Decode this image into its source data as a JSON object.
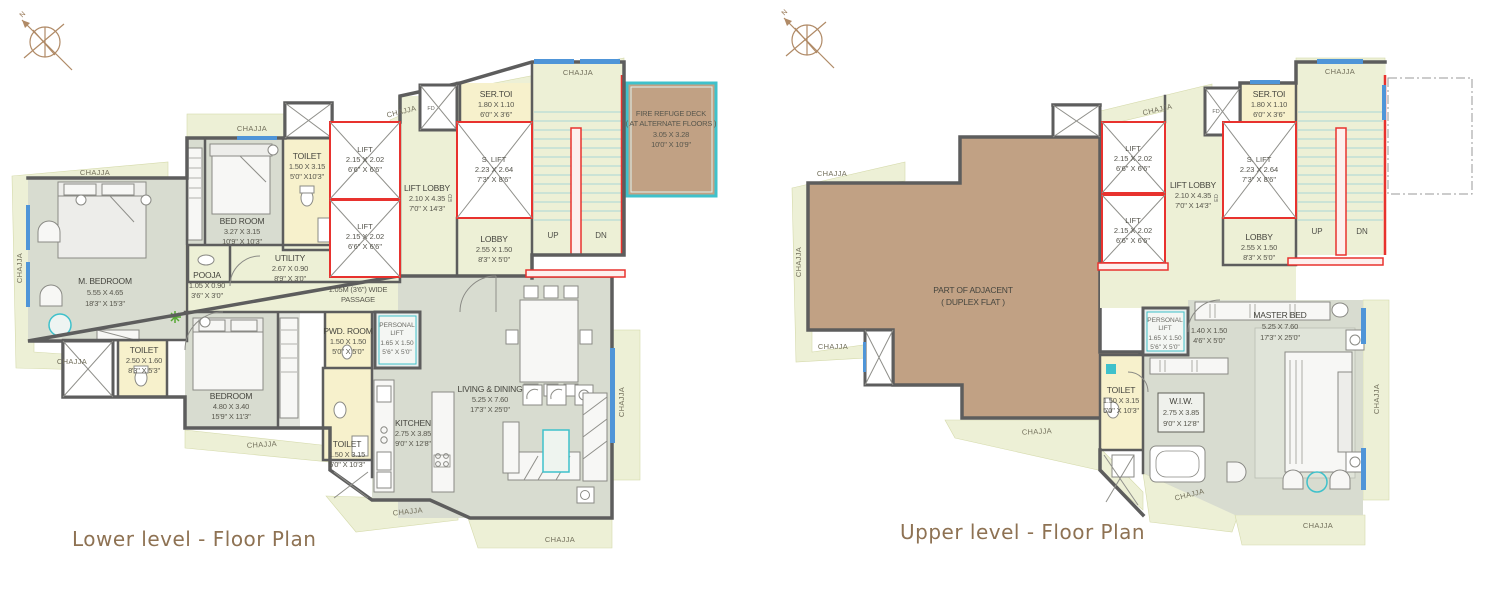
{
  "titles": {
    "lower": "Lower level - Floor Plan",
    "upper": "Upper level - Floor Plan"
  },
  "common": {
    "chajja": "CHAJJA",
    "up": "UP",
    "dn": "DN",
    "north": "N",
    "fd": "FD",
    "ed": "ED",
    "lift": {
      "name": "LIFT",
      "m": "2.15 X 2.02",
      "ft": "6'6\" X 6'6\""
    },
    "slift": {
      "name": "S. LIFT",
      "m": "2.23 X 2.64",
      "ft": "7'3\" X 8'6\""
    },
    "lift_lobby": {
      "name": "LIFT LOBBY",
      "m": "2.10 X 4.35",
      "ft": "7'0\" X 14'3\""
    },
    "lobby": {
      "name": "LOBBY",
      "m": "2.55 X 1.50",
      "ft": "8'3\" X 5'0\""
    },
    "sertoi": {
      "name": "SER.TOI",
      "m": "1.80 X 1.10",
      "ft": "6'0\" X 3'6\""
    },
    "personal_lift": {
      "l1": "PERSONAL",
      "l2": "LIFT",
      "m": "1.65 X 1.50",
      "ft": "5'6\" X 5'0\""
    }
  },
  "lower": {
    "m_bedroom": {
      "name": "M. BEDROOM",
      "m": "5.55 X 4.65",
      "ft": "18'3\" X 15'3\""
    },
    "toilet_top": {
      "name": "TOILET",
      "m": "1.50 X 3.15",
      "ft": "5'0\" X10'3\""
    },
    "bed_room": {
      "name": "BED ROOM",
      "m": "3.27 X 3.15",
      "ft": "10'9\" X 10'3\""
    },
    "pooja": {
      "name": "POOJA",
      "m": "1.05 X 0.90",
      "ft": "3'6\" X 3'0\""
    },
    "utility": {
      "name": "UTILITY",
      "m": "2.67 X 0.90",
      "ft": "8'9\" X 3'0\""
    },
    "passage": {
      "l1": "1.05M (3'6\") WIDE",
      "l2": "PASSAGE"
    },
    "toilet_mid": {
      "name": "TOILET",
      "m": "2.50 X 1.60",
      "ft": "8'3\" X 5'3\""
    },
    "bedroom": {
      "name": "BEDROOM",
      "m": "4.80 X 3.40",
      "ft": "15'9\" X 11'3\""
    },
    "pwd": {
      "name": "PWD. ROOM",
      "m": "1.50 X 1.50",
      "ft": "5'0\" X 5'0\""
    },
    "toilet_kitchen": {
      "name": "TOILET",
      "m": "1.50 X 3.15",
      "ft": "5'0\" X 10'3\""
    },
    "kitchen": {
      "name": "KITCHEN",
      "m": "2.75 X 3.85",
      "ft": "9'0\" X 12'8\""
    },
    "living": {
      "name": "LIVING & DINING",
      "m": "5.25 X 7.60",
      "ft": "17'3\" X 25'0\""
    },
    "fire_deck": {
      "l1": "FIRE REFUGE DECK",
      "l2": "( AT ALTERNATE FLOORS )",
      "m": "3.05 X 3.28",
      "ft": "10'0\" X 10'9\""
    }
  },
  "upper": {
    "adjacent": {
      "l1": "PART OF ADJACENT",
      "l2": "( DUPLEX FLAT )"
    },
    "lobby_dim": {
      "m": "1.40 X 1.50",
      "ft": "4'6\" X 5'0\""
    },
    "toilet": {
      "name": "TOILET",
      "m": "1.50 X 3.15",
      "ft": "5'0\" X 10'3\""
    },
    "wiw": {
      "name": "W.I.W.",
      "m": "2.75 X 3.85",
      "ft": "9'0\" X 12'8\""
    },
    "master": {
      "name": "MASTER BED",
      "m": "5.25 X 7.60",
      "ft": "17'3\" X 25'0\""
    }
  },
  "colors": {
    "wall": "#5d5d5d",
    "floor": "#d8dcd0",
    "pale_green": "#edf0d6",
    "toilet_yellow": "#f7f1cc",
    "brown": "#c1a184",
    "accent_cyan": "#3fc1cb",
    "lift_red": "#e8322e",
    "window_blue": "#4f95d8",
    "title_brown": "#8e7253"
  }
}
